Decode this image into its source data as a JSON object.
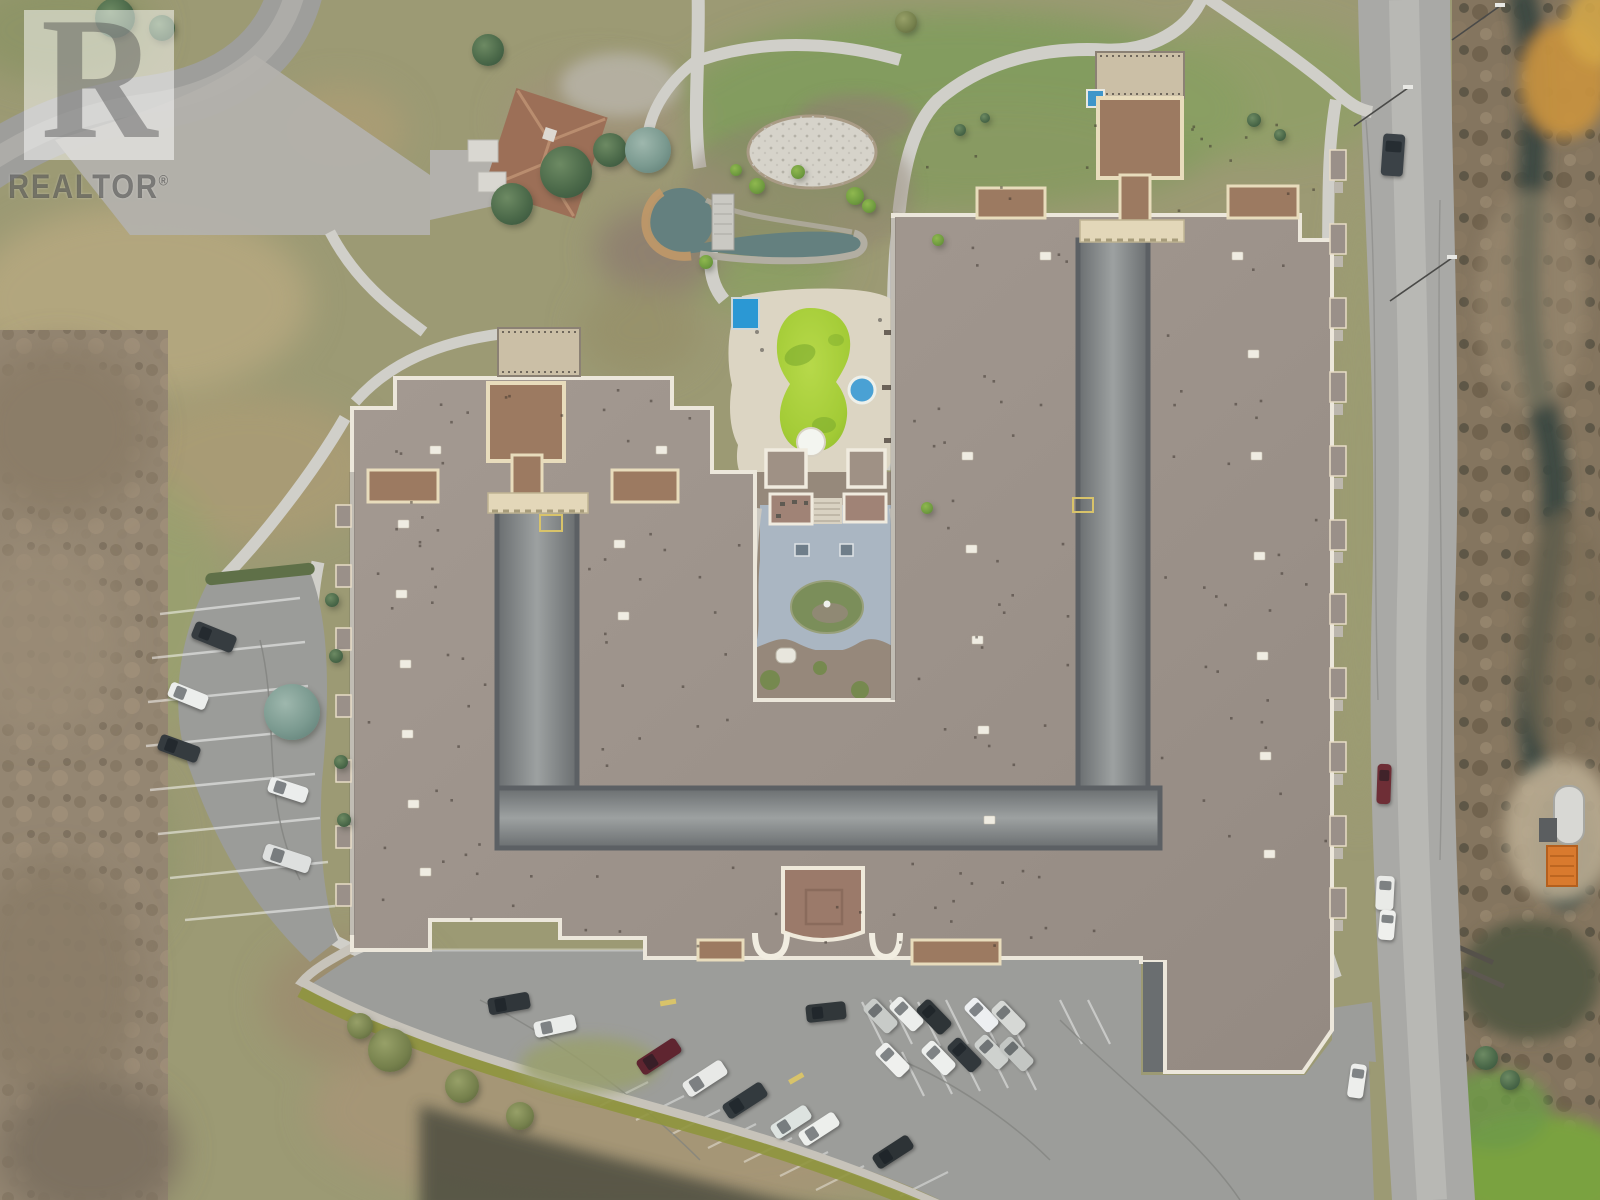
{
  "meta": {
    "description": "Aerial drone photograph of a large U-shaped condominium complex with courtyards, pool, pond, parking lots and surrounding winter landscape",
    "season_look": "late autumn / winter, bare trees, olive-tan grass"
  },
  "watermark": {
    "letter": "R",
    "label": "REALTOR",
    "reg": "®"
  },
  "palette": {
    "grass_olive": "#9c9a74",
    "grass_green": "#7f9c5c",
    "grass_dry": "#b2a67e",
    "roof_main": "#a0968e",
    "roof_trim": "#ece7db",
    "roof_red": "#9c7a61",
    "trim_cream": "#e8dcbc",
    "court_paving": "#aab6c2",
    "courtyard_drive": "#95999a",
    "pool_green": "#a9ce3b",
    "hot_tub_blue": "#4aa1d4",
    "canopy_blue": "#2b98d4",
    "pond_water": "#64807f",
    "pond_rocks_tan": "#c09868",
    "gravel": "#d6d3ca",
    "deck": "#dcd5c3",
    "asphalt": "#9c9d9a",
    "road": "#a9a9a6",
    "path": "#d0cfc9",
    "hedge": "#8f953e",
    "dark_brush": "#4e4e40",
    "dumpster_orange": "#d97a2e"
  },
  "scene": {
    "cars": [
      [
        1382,
        134,
        22,
        42,
        4,
        "#3b4247"
      ],
      [
        1377,
        764,
        14,
        40,
        2,
        "#6e2e36"
      ],
      [
        1376,
        876,
        18,
        34,
        3,
        "#e9eae7"
      ],
      [
        1379,
        910,
        16,
        30,
        5,
        "#eff0ed"
      ],
      [
        1349,
        1064,
        16,
        34,
        8,
        "#edeeec"
      ],
      [
        872,
        998,
        17,
        36,
        -44,
        "#c8cbc8"
      ],
      [
        898,
        996,
        17,
        36,
        -44,
        "#eceeec"
      ],
      [
        925,
        999,
        18,
        36,
        -44,
        "#2e3437"
      ],
      [
        973,
        997,
        17,
        36,
        -44,
        "#edeff1"
      ],
      [
        1000,
        1000,
        17,
        36,
        -44,
        "#d6d8d5"
      ],
      [
        884,
        1042,
        17,
        36,
        -44,
        "#eff0ee"
      ],
      [
        930,
        1040,
        17,
        36,
        -44,
        "#edefed"
      ],
      [
        956,
        1037,
        17,
        36,
        -44,
        "#32383c"
      ],
      [
        983,
        1034,
        17,
        36,
        -44,
        "#ced1ce"
      ],
      [
        1008,
        1036,
        17,
        36,
        -44,
        "#c3c6c3"
      ],
      [
        806,
        1003,
        40,
        18,
        -6,
        "#31373a"
      ],
      [
        636,
        1048,
        46,
        17,
        -33,
        "#5f2530"
      ],
      [
        682,
        1070,
        46,
        17,
        -33,
        "#e8e9e7"
      ],
      [
        722,
        1092,
        46,
        17,
        -33,
        "#333a3e"
      ],
      [
        770,
        1114,
        42,
        16,
        -33,
        "#dde3e0"
      ],
      [
        798,
        1121,
        42,
        16,
        -33,
        "#edefec"
      ],
      [
        872,
        1144,
        42,
        16,
        -33,
        "#2d3336"
      ],
      [
        488,
        995,
        42,
        17,
        -10,
        "#30363a"
      ],
      [
        534,
        1018,
        42,
        16,
        -12,
        "#eaecea"
      ],
      [
        192,
        628,
        44,
        18,
        22,
        "#363c40"
      ],
      [
        168,
        688,
        40,
        16,
        22,
        "#eceeec"
      ],
      [
        158,
        740,
        42,
        17,
        20,
        "#353b3f"
      ],
      [
        268,
        782,
        40,
        16,
        18,
        "#ebedec"
      ],
      [
        263,
        850,
        48,
        17,
        18,
        "#dee0df"
      ]
    ],
    "trees": [
      [
        566,
        172,
        26,
        "ever"
      ],
      [
        610,
        150,
        17,
        "ever"
      ],
      [
        512,
        204,
        21,
        "ever"
      ],
      [
        488,
        50,
        16,
        "ever"
      ],
      [
        115,
        18,
        20,
        "ever"
      ],
      [
        162,
        28,
        13,
        "ever"
      ],
      [
        648,
        150,
        23,
        "spruce"
      ],
      [
        292,
        712,
        28,
        "spruce"
      ],
      [
        855,
        196,
        9,
        "bright"
      ],
      [
        869,
        206,
        7,
        "bright"
      ],
      [
        757,
        186,
        8,
        "bright"
      ],
      [
        798,
        172,
        7,
        "bright"
      ],
      [
        706,
        262,
        7,
        "bright"
      ],
      [
        736,
        170,
        6,
        "bright"
      ],
      [
        938,
        240,
        6,
        "bright"
      ],
      [
        927,
        508,
        6,
        "bright"
      ],
      [
        390,
        1050,
        22,
        "olive"
      ],
      [
        462,
        1086,
        17,
        "olive"
      ],
      [
        360,
        1026,
        13,
        "olive"
      ],
      [
        520,
        1116,
        14,
        "olive"
      ],
      [
        332,
        600,
        7,
        "ever"
      ],
      [
        336,
        656,
        7,
        "ever"
      ],
      [
        341,
        762,
        7,
        "ever"
      ],
      [
        344,
        820,
        7,
        "ever"
      ],
      [
        906,
        22,
        11,
        "olive"
      ],
      [
        1254,
        120,
        7,
        "ever"
      ],
      [
        1280,
        135,
        6,
        "ever"
      ],
      [
        960,
        130,
        6,
        "ever"
      ],
      [
        985,
        118,
        5,
        "ever"
      ],
      [
        1486,
        1058,
        12,
        "ever"
      ],
      [
        1510,
        1080,
        10,
        "ever"
      ]
    ],
    "balconies_east_y": [
      150,
      224,
      298,
      372,
      446,
      520,
      594,
      668,
      742,
      816,
      888
    ],
    "balconies_west_y": [
      505,
      565,
      628,
      695,
      760,
      826,
      884
    ],
    "roof_plaques": [
      [
        398,
        520
      ],
      [
        396,
        590
      ],
      [
        400,
        660
      ],
      [
        402,
        730
      ],
      [
        408,
        800
      ],
      [
        420,
        868
      ],
      [
        614,
        540
      ],
      [
        618,
        612
      ],
      [
        962,
        452
      ],
      [
        966,
        545
      ],
      [
        972,
        636
      ],
      [
        978,
        726
      ],
      [
        984,
        816
      ],
      [
        1248,
        350
      ],
      [
        1251,
        452
      ],
      [
        1254,
        552
      ],
      [
        1257,
        652
      ],
      [
        1260,
        752
      ],
      [
        1264,
        850
      ],
      [
        1040,
        252
      ],
      [
        1232,
        252
      ],
      [
        430,
        446
      ],
      [
        656,
        446
      ]
    ],
    "streetlights": [
      [
        1408,
        88,
        1354,
        126
      ],
      [
        1452,
        258,
        1390,
        301
      ],
      [
        1500,
        6,
        1452,
        40
      ]
    ]
  }
}
